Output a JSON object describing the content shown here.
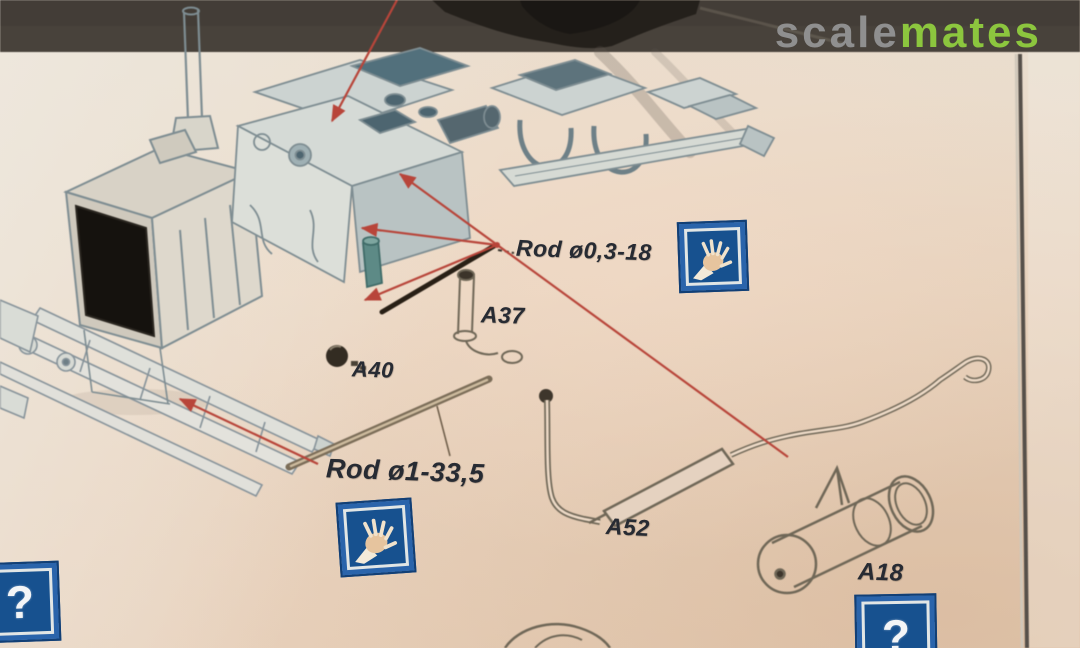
{
  "watermark": {
    "scale": "scale",
    "mates": "mates"
  },
  "diagram": {
    "type": "model-kit-assembly-instruction-photo",
    "labels": {
      "rod_small": "Rod ø0,3-18",
      "rod_large": "Rod ø1-33,5",
      "a37": "A37",
      "a40": "A40",
      "a52": "A52",
      "a18": "A18"
    },
    "icons": {
      "question_glyph": "?",
      "hand": "hand-icon",
      "question": "question-icon"
    },
    "colors": {
      "paper": "#ebd9c6",
      "photo_background_strip": "#48423b",
      "line_art": "#7e8d92",
      "dark_fill": "#4d6570",
      "arrow_red": "#b8453a",
      "rod_black": "#281f15",
      "rod_brown": "#7b6d58",
      "icon_blue": "#17518f",
      "label_ink": "#272b33",
      "watermark_gray": "#8f8f8f",
      "watermark_green": "#8cc63e"
    }
  }
}
